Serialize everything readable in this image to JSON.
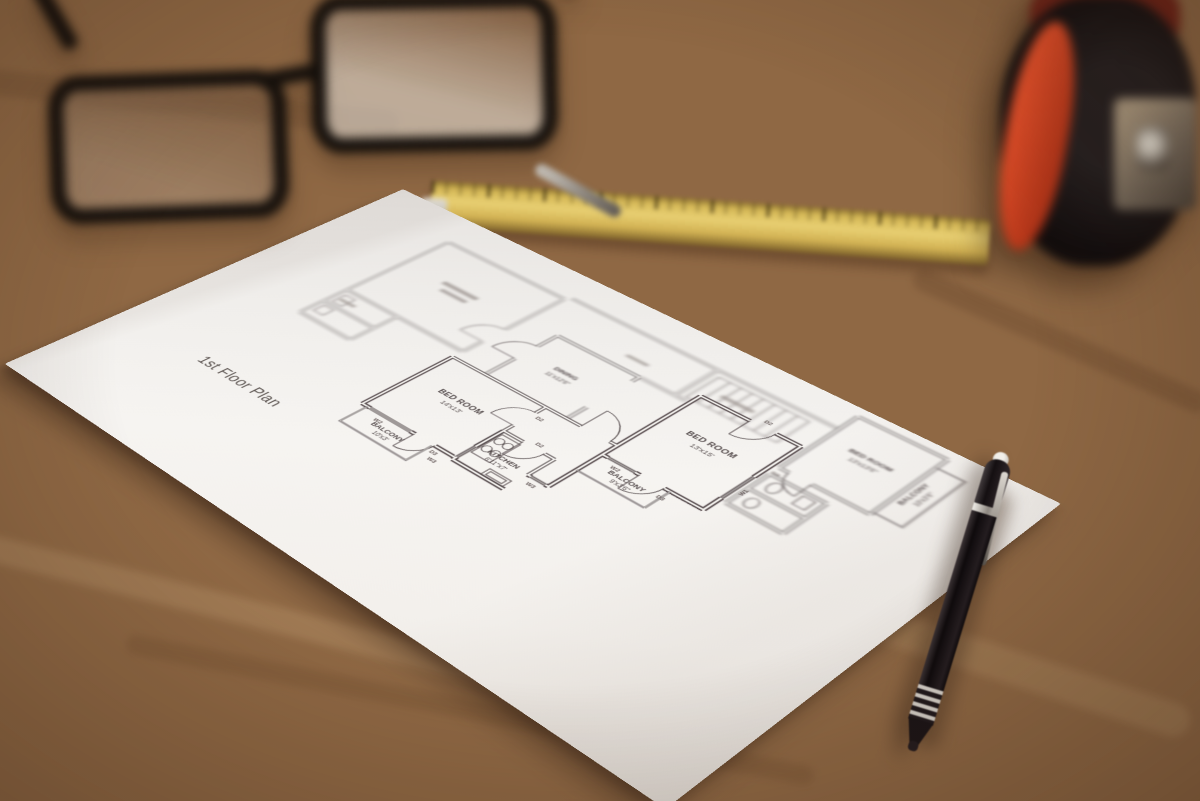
{
  "floor_plan": {
    "title": "1st Floor Plan",
    "line_color": "#4a4143",
    "paper_color": "#f4f2ef",
    "rooms": [
      {
        "name": "BED ROOM",
        "dims": "14'x13'"
      },
      {
        "name": "BALCONY",
        "dims": "10'x3'"
      },
      {
        "name": "KITCHEN",
        "dims": "6'11\"x7'"
      },
      {
        "name": "DINING",
        "dims": "11'x12'6\""
      },
      {
        "name": "BED ROOM",
        "dims": "13'x15'"
      },
      {
        "name": "BALCONY",
        "dims": "9'x3'6\""
      },
      {
        "name": "BED ROOM",
        "dims": "13'x13'6\""
      },
      {
        "name": "BALCONY",
        "dims": "10'x3'6\""
      }
    ],
    "markers": {
      "w1": "W1",
      "w2": "W2",
      "w3": "W3",
      "d2": "D2",
      "d3": "D3"
    }
  },
  "objects": {
    "desk": {
      "name": "wooden desk",
      "color": "#9a7148"
    },
    "glasses": {
      "name": "eyeglasses",
      "frame_color": "#171310"
    },
    "ruler": {
      "name": "folding ruler",
      "color": "#d9b955"
    },
    "tape_measure": {
      "name": "tape measure",
      "body_color": "#16110f",
      "accent_color": "#e04f28"
    },
    "pen": {
      "name": "ballpoint pen",
      "body_color": "#16120f"
    }
  }
}
